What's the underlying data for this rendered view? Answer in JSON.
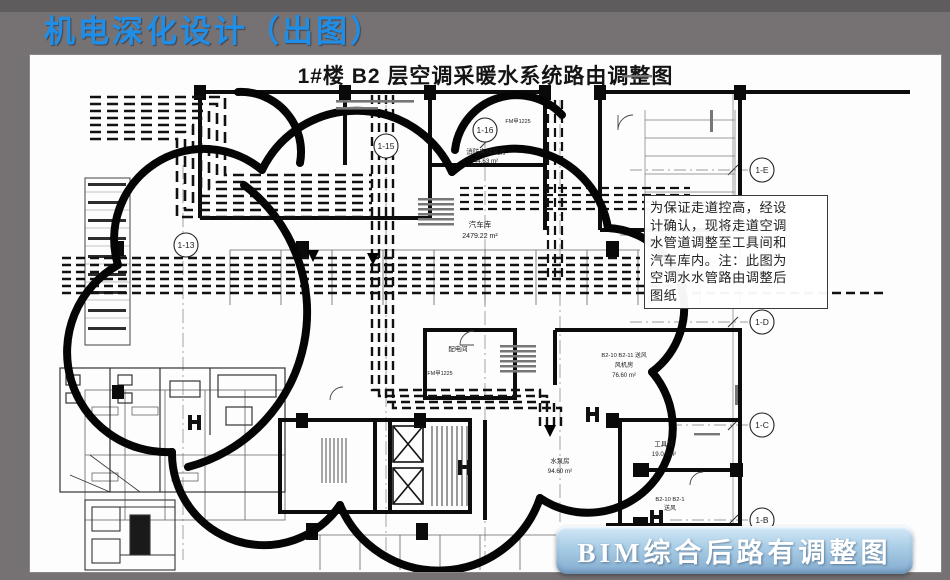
{
  "slide": {
    "header_title": "机电深化设计（出图）",
    "accent_color": "#1e8ee8",
    "background_color": "#767274"
  },
  "drawing": {
    "title": "1#楼 B2 层空调采暖水系统路由调整图",
    "note": {
      "lines": [
        "为保证走道控高，经设",
        "计确认，现将走道空调",
        "水管道调整至工具间和",
        "汽车库内。注：此图为",
        "空调水水管路由调整后",
        "图纸"
      ]
    },
    "banner_label": "BIM综合后路有调整图",
    "grid_bubbles": {
      "b13": "1-13",
      "b15": "1-15",
      "b16": "1-16",
      "bE": "1-E",
      "bD": "1-D",
      "bC": "1-C",
      "bB": "1-B"
    },
    "rooms": {
      "fire_elevator": {
        "name": "消防电梯机房",
        "area": "44.63 m²"
      },
      "garage": {
        "name": "汽车库",
        "area": "2479.22 m²"
      },
      "power": {
        "name": "配电间"
      },
      "fan": {
        "tag": "B2-10 B2-11 送风",
        "name": "风机房",
        "area": "76.60 m²"
      },
      "pump": {
        "name": "水泵房",
        "area": "94.60 m²"
      },
      "tool": {
        "name": "工具间",
        "area": "19.04 m²"
      },
      "supply": {
        "tag": "B2-10 B2-1",
        "name": "送风"
      }
    },
    "door_tag": "FM甲1225"
  }
}
